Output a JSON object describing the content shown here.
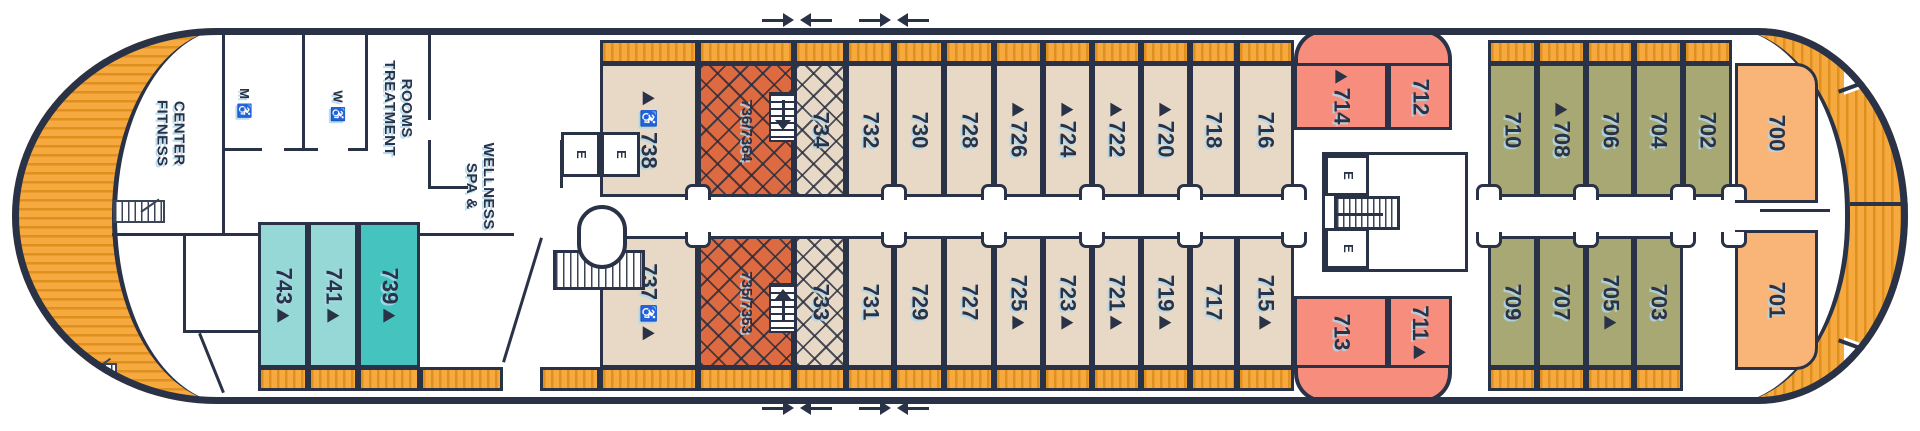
{
  "palette": {
    "navy": "#2a3247",
    "beige": "#e7d9c5",
    "terracotta": "#de6a42",
    "salmon": "#f78e7d",
    "olive": "#a7a873",
    "peach": "#f9b478",
    "teal_light": "#96d8d5",
    "teal_dark": "#45c4bf",
    "deck_orange": "#f6a93f",
    "deck_stripe": "#e0901f"
  },
  "labels": {
    "fitness_1": "FITNESS",
    "fitness_2": "CENTER",
    "mens": "M ♿",
    "womens": "W ♿",
    "treatment_1": "TREATMENT",
    "treatment_2": "ROOMS",
    "spa_1": "SPA &",
    "spa_2": "WELLNESS",
    "elevator": "E"
  },
  "cabins": [
    {
      "num": "738",
      "row": "top",
      "x": 600,
      "w": 98,
      "color": "beige",
      "wheelchair": true,
      "triangle": "before"
    },
    {
      "num": "736/7364",
      "row": "top",
      "x": 698,
      "w": 96,
      "color": "terracotta",
      "hatch": true,
      "stairs": "down",
      "small": true
    },
    {
      "num": "734",
      "row": "top",
      "x": 794,
      "w": 52,
      "color": "beige",
      "hatch": true
    },
    {
      "num": "732",
      "row": "top",
      "x": 846,
      "w": 48,
      "color": "beige"
    },
    {
      "num": "730",
      "row": "top",
      "x": 894,
      "w": 50,
      "color": "beige"
    },
    {
      "num": "728",
      "row": "top",
      "x": 944,
      "w": 50,
      "color": "beige"
    },
    {
      "num": "726",
      "row": "top",
      "x": 994,
      "w": 49,
      "color": "beige",
      "triangle": "before"
    },
    {
      "num": "724",
      "row": "top",
      "x": 1043,
      "w": 49,
      "color": "beige",
      "triangle": "before"
    },
    {
      "num": "722",
      "row": "top",
      "x": 1092,
      "w": 49,
      "color": "beige",
      "triangle": "before"
    },
    {
      "num": "720",
      "row": "top",
      "x": 1141,
      "w": 49,
      "color": "beige",
      "triangle": "before"
    },
    {
      "num": "718",
      "row": "top",
      "x": 1190,
      "w": 47,
      "color": "beige"
    },
    {
      "num": "716",
      "row": "top",
      "x": 1237,
      "w": 57,
      "color": "beige"
    },
    {
      "num": "714",
      "row": "top",
      "x": 1294,
      "w": 94,
      "color": "salmon",
      "triangle": "before",
      "y": 63,
      "h": 67,
      "balcony": false
    },
    {
      "num": "712",
      "row": "top",
      "x": 1388,
      "w": 64,
      "color": "salmon",
      "y": 63,
      "h": 67,
      "balcony": false
    },
    {
      "num": "710",
      "row": "top",
      "x": 1488,
      "w": 49,
      "color": "olive"
    },
    {
      "num": "708",
      "row": "top",
      "x": 1537,
      "w": 49,
      "color": "olive",
      "triangle": "before"
    },
    {
      "num": "706",
      "row": "top",
      "x": 1586,
      "w": 48,
      "color": "olive"
    },
    {
      "num": "704",
      "row": "top",
      "x": 1634,
      "w": 49,
      "color": "olive"
    },
    {
      "num": "702",
      "row": "top",
      "x": 1683,
      "w": 49,
      "color": "olive"
    },
    {
      "num": "700",
      "row": "top",
      "x": 1735,
      "w": 83,
      "color": "peach",
      "y": 63,
      "h": 140,
      "balcony": false,
      "round": "tr"
    },
    {
      "num": "743",
      "row": "bottom",
      "x": 258,
      "w": 50,
      "color": "teal_light",
      "triangle": "after",
      "y": 222,
      "h": 146
    },
    {
      "num": "741",
      "row": "bottom",
      "x": 308,
      "w": 50,
      "color": "teal_light",
      "triangle": "after",
      "y": 222,
      "h": 146
    },
    {
      "num": "739",
      "row": "bottom",
      "x": 358,
      "w": 62,
      "color": "teal_dark",
      "triangle": "after",
      "y": 222,
      "h": 146
    },
    {
      "num": "737",
      "row": "bottom",
      "x": 600,
      "w": 98,
      "color": "beige",
      "wheelchair": true,
      "triangle": "after"
    },
    {
      "num": "735/7353",
      "row": "bottom",
      "x": 698,
      "w": 96,
      "color": "terracotta",
      "hatch": true,
      "stairs": "up",
      "small": true
    },
    {
      "num": "733",
      "row": "bottom",
      "x": 794,
      "w": 52,
      "color": "beige",
      "hatch": true
    },
    {
      "num": "731",
      "row": "bottom",
      "x": 846,
      "w": 48,
      "color": "beige"
    },
    {
      "num": "729",
      "row": "bottom",
      "x": 894,
      "w": 50,
      "color": "beige"
    },
    {
      "num": "727",
      "row": "bottom",
      "x": 944,
      "w": 50,
      "color": "beige"
    },
    {
      "num": "725",
      "row": "bottom",
      "x": 994,
      "w": 49,
      "color": "beige",
      "triangle": "after"
    },
    {
      "num": "723",
      "row": "bottom",
      "x": 1043,
      "w": 49,
      "color": "beige",
      "triangle": "after"
    },
    {
      "num": "721",
      "row": "bottom",
      "x": 1092,
      "w": 49,
      "color": "beige",
      "triangle": "after"
    },
    {
      "num": "719",
      "row": "bottom",
      "x": 1141,
      "w": 49,
      "color": "beige",
      "triangle": "after"
    },
    {
      "num": "717",
      "row": "bottom",
      "x": 1190,
      "w": 47,
      "color": "beige"
    },
    {
      "num": "715",
      "row": "bottom",
      "x": 1237,
      "w": 57,
      "color": "beige",
      "triangle": "after"
    },
    {
      "num": "713",
      "row": "bottom",
      "x": 1294,
      "w": 94,
      "color": "salmon",
      "y": 296,
      "h": 72,
      "balcony": false
    },
    {
      "num": "711",
      "row": "bottom",
      "x": 1388,
      "w": 64,
      "color": "salmon",
      "triangle": "after",
      "y": 296,
      "h": 72,
      "balcony": false
    },
    {
      "num": "709",
      "row": "bottom",
      "x": 1488,
      "w": 49,
      "color": "olive"
    },
    {
      "num": "707",
      "row": "bottom",
      "x": 1537,
      "w": 49,
      "color": "olive"
    },
    {
      "num": "705",
      "row": "bottom",
      "x": 1586,
      "w": 48,
      "color": "olive",
      "triangle": "after"
    },
    {
      "num": "703",
      "row": "bottom",
      "x": 1634,
      "w": 49,
      "color": "olive"
    },
    {
      "num": "701",
      "row": "bottom",
      "x": 1735,
      "w": 83,
      "color": "peach",
      "y": 230,
      "h": 140,
      "balcony": false,
      "round": "br"
    }
  ],
  "corridor_alcoves_x": [
    698,
    894,
    994,
    1092,
    1190,
    1294,
    1489,
    1586,
    1683,
    1734
  ],
  "watertight_door_arrows_x": [
    797,
    894
  ],
  "extra_balconies": [
    {
      "row": "bottom",
      "x": 420,
      "w": 83
    },
    {
      "row": "bottom",
      "x": 540,
      "w": 60
    }
  ]
}
